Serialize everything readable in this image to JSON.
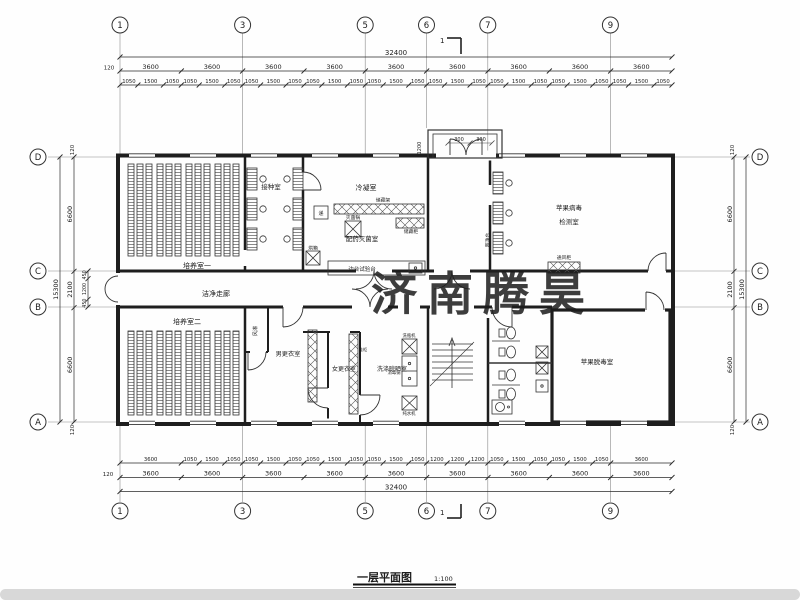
{
  "watermark": {
    "text": "济南腾昊",
    "color": "#e2383f"
  },
  "title": {
    "name": "一层平面图",
    "scale": "1:100"
  },
  "axes": {
    "top": [
      "1",
      "3",
      "5",
      "6",
      "7",
      "9"
    ],
    "bottom": [
      "1",
      "3",
      "5",
      "6",
      "7",
      "9"
    ],
    "left": [
      "D",
      "C",
      "B",
      "A"
    ],
    "right": [
      "D",
      "C",
      "B",
      "A"
    ]
  },
  "dims": {
    "top": {
      "overall": [
        "32400"
      ],
      "bays": [
        "3600",
        "3600",
        "3600",
        "3600",
        "3600",
        "3600",
        "3600",
        "3600",
        "3600"
      ],
      "small": [
        "1050",
        "1500",
        "1050",
        "1050",
        "1500",
        "1050",
        "1050",
        "1500",
        "1050",
        "1050",
        "1500",
        "1050",
        "1050",
        "1500",
        "1050",
        "1050",
        "1500",
        "1050",
        "1050",
        "1500",
        "1050",
        "1050",
        "1500",
        "1050",
        "1050",
        "1500",
        "1050"
      ],
      "cap": "120"
    },
    "bottom": {
      "overall": [
        "32400"
      ],
      "bays": [
        "3600",
        "3600",
        "3600",
        "3600",
        "3600",
        "3600",
        "3600",
        "3600",
        "3600"
      ],
      "small": [
        "3600",
        "1050",
        "1500",
        "1050",
        "1050",
        "1500",
        "1050",
        "1050",
        "1500",
        "1050",
        "1050",
        "1500",
        "1050",
        "1200",
        "1200",
        "1200",
        "1050",
        "1500",
        "1050",
        "1050",
        "1500",
        "1050",
        "3600"
      ],
      "cap": "120"
    },
    "left": {
      "overall": [
        "15300"
      ],
      "majors": [
        "6600",
        "2100",
        "6600"
      ],
      "subs": [
        "450",
        "1200",
        "450"
      ],
      "cap_top": "120",
      "cap_bottom": "120"
    },
    "right": {
      "overall": [
        "15300"
      ],
      "majors": [
        "6600",
        "2100",
        "6600"
      ],
      "cap_top": "120",
      "cap_bottom": "120"
    },
    "entrance": [
      "1200",
      "300",
      "300"
    ]
  },
  "rooms": {
    "culture1": "培养室一",
    "inoculation": "接种室",
    "condensation": "冷凝室",
    "prep_steril": "配药灭菌室",
    "virus_test_l1": "苹果病毒",
    "virus_test_l2": "检测室",
    "corridor": "洁净走廊",
    "culture2": "培养室二",
    "mens_change": "男更衣室",
    "womens_change": "女更衣室",
    "washing": "洗涤晾晒室",
    "detox": "苹果脱毒室"
  },
  "equipment": {
    "sterilizer": "灭菌锅",
    "storage_rack": "储藏架",
    "storage_cabinet": "储藏柜",
    "oven": "烘箱",
    "side_bench": "边台试验台",
    "pass_box": "递",
    "clean_bench": "超净台",
    "fume_hood": "通风柜",
    "air_shower": "风淋",
    "shoe_cabinet": "鞋柜",
    "bottle_washer": "洗瓶机",
    "disinfect_pot": "消毒锅",
    "water_purifier": "纯水机"
  },
  "section_marks": {
    "top": "1",
    "bottom": "1"
  }
}
